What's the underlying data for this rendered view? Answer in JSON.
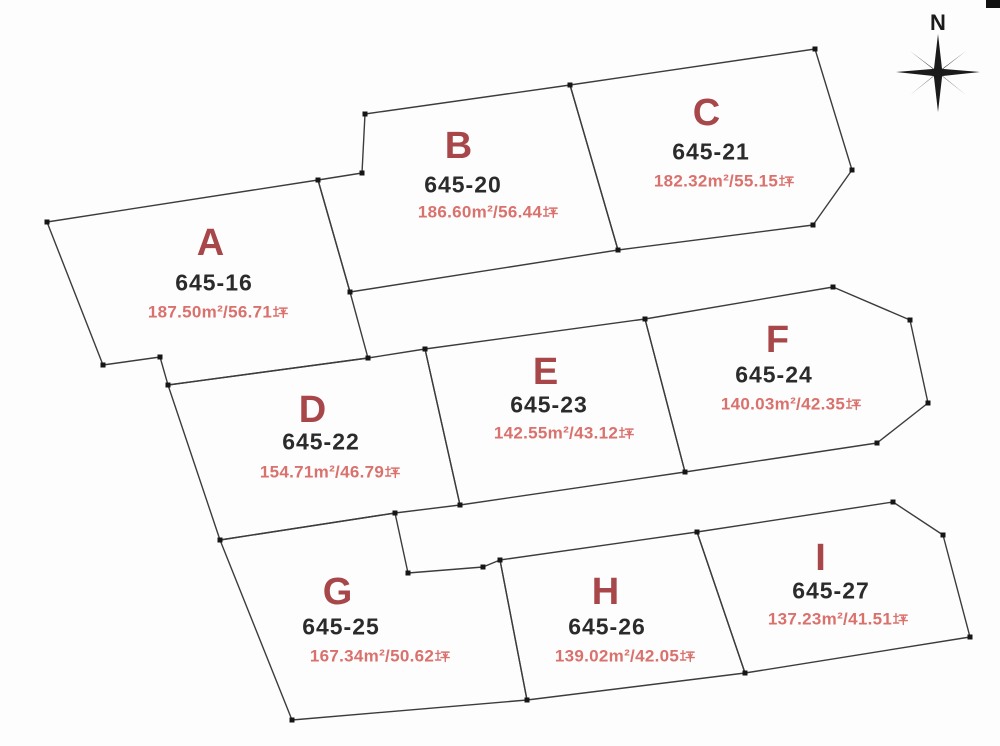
{
  "canvas": {
    "width": 1000,
    "height": 746,
    "background": "#fdfdfd"
  },
  "colors": {
    "boundary_line": "#3c3c3c",
    "vertex_marker": "#161616",
    "plot_letter": "#a8474a",
    "lot_number": "#2b2b2b",
    "area_text": "#d9716d",
    "compass": "#1b1b1b",
    "corner_mark": "#111111"
  },
  "compass": {
    "label": "N"
  },
  "plots": [
    {
      "letter": "A",
      "lot_number": "645-16",
      "area_text": "187.50㎡/56.71坪",
      "area_m2": "187.50",
      "area_tsubo": "56.71",
      "polygon": [
        [
          47,
          222
        ],
        [
          318,
          180
        ],
        [
          350,
          292
        ],
        [
          368,
          358
        ],
        [
          168,
          385
        ],
        [
          160,
          357
        ],
        [
          103,
          365
        ]
      ],
      "letter_pos": {
        "x": 211,
        "y": 243
      },
      "lot_pos": {
        "x": 214,
        "y": 283
      },
      "area_pos": {
        "x": 218,
        "y": 312
      }
    },
    {
      "letter": "B",
      "lot_number": "645-20",
      "area_text": "186.60㎡/56.44坪",
      "area_m2": "186.60",
      "area_tsubo": "56.44",
      "polygon": [
        [
          365,
          114
        ],
        [
          570,
          85
        ],
        [
          618,
          250
        ],
        [
          350,
          292
        ],
        [
          318,
          180
        ],
        [
          362,
          173
        ]
      ],
      "letter_pos": {
        "x": 459,
        "y": 146
      },
      "lot_pos": {
        "x": 463,
        "y": 185
      },
      "area_pos": {
        "x": 488,
        "y": 212
      }
    },
    {
      "letter": "C",
      "lot_number": "645-21",
      "area_text": "182.32㎡/55.15坪",
      "area_m2": "182.32",
      "area_tsubo": "55.15",
      "polygon": [
        [
          570,
          85
        ],
        [
          815,
          49
        ],
        [
          852,
          170
        ],
        [
          813,
          225
        ],
        [
          618,
          250
        ]
      ],
      "letter_pos": {
        "x": 707,
        "y": 113
      },
      "lot_pos": {
        "x": 711,
        "y": 152
      },
      "area_pos": {
        "x": 724,
        "y": 181
      }
    },
    {
      "letter": "D",
      "lot_number": "645-22",
      "area_text": "154.71㎡/46.79坪",
      "area_m2": "154.71",
      "area_tsubo": "46.79",
      "polygon": [
        [
          168,
          385
        ],
        [
          368,
          358
        ],
        [
          425,
          349
        ],
        [
          460,
          505
        ],
        [
          395,
          513
        ],
        [
          220,
          540
        ]
      ],
      "letter_pos": {
        "x": 313,
        "y": 410
      },
      "lot_pos": {
        "x": 321,
        "y": 442
      },
      "area_pos": {
        "x": 330,
        "y": 472
      }
    },
    {
      "letter": "E",
      "lot_number": "645-23",
      "area_text": "142.55㎡/43.12坪",
      "area_m2": "142.55",
      "area_tsubo": "43.12",
      "polygon": [
        [
          425,
          349
        ],
        [
          645,
          319
        ],
        [
          685,
          472
        ],
        [
          460,
          505
        ]
      ],
      "letter_pos": {
        "x": 546,
        "y": 372
      },
      "lot_pos": {
        "x": 549,
        "y": 405
      },
      "area_pos": {
        "x": 564,
        "y": 433
      }
    },
    {
      "letter": "F",
      "lot_number": "645-24",
      "area_text": "140.03㎡/42.35坪",
      "area_m2": "140.03",
      "area_tsubo": "42.35",
      "polygon": [
        [
          645,
          319
        ],
        [
          833,
          287
        ],
        [
          910,
          320
        ],
        [
          928,
          403
        ],
        [
          877,
          443
        ],
        [
          685,
          472
        ]
      ],
      "letter_pos": {
        "x": 778,
        "y": 340
      },
      "lot_pos": {
        "x": 774,
        "y": 375
      },
      "area_pos": {
        "x": 791,
        "y": 404
      }
    },
    {
      "letter": "G",
      "lot_number": "645-25",
      "area_text": "167.34㎡/50.62坪",
      "area_m2": "167.34",
      "area_tsubo": "50.62",
      "polygon": [
        [
          220,
          540
        ],
        [
          395,
          513
        ],
        [
          408,
          573
        ],
        [
          483,
          567
        ],
        [
          500,
          560
        ],
        [
          527,
          700
        ],
        [
          292,
          720
        ]
      ],
      "letter_pos": {
        "x": 338,
        "y": 592
      },
      "lot_pos": {
        "x": 341,
        "y": 627
      },
      "area_pos": {
        "x": 380,
        "y": 656
      }
    },
    {
      "letter": "H",
      "lot_number": "645-26",
      "area_text": "139.02㎡/42.05坪",
      "area_m2": "139.02",
      "area_tsubo": "42.05",
      "polygon": [
        [
          500,
          560
        ],
        [
          697,
          532
        ],
        [
          745,
          673
        ],
        [
          527,
          700
        ]
      ],
      "letter_pos": {
        "x": 606,
        "y": 592
      },
      "lot_pos": {
        "x": 607,
        "y": 627
      },
      "area_pos": {
        "x": 625,
        "y": 656
      }
    },
    {
      "letter": "I",
      "lot_number": "645-27",
      "area_text": "137.23㎡/41.51坪",
      "area_m2": "137.23",
      "area_tsubo": "41.51",
      "polygon": [
        [
          697,
          532
        ],
        [
          893,
          502
        ],
        [
          943,
          535
        ],
        [
          970,
          637
        ],
        [
          745,
          673
        ]
      ],
      "letter_pos": {
        "x": 821,
        "y": 558
      },
      "lot_pos": {
        "x": 831,
        "y": 591
      },
      "area_pos": {
        "x": 838,
        "y": 619
      }
    }
  ],
  "corner_mark": {
    "x": 986,
    "y": 0,
    "width": 14,
    "height": 8
  }
}
